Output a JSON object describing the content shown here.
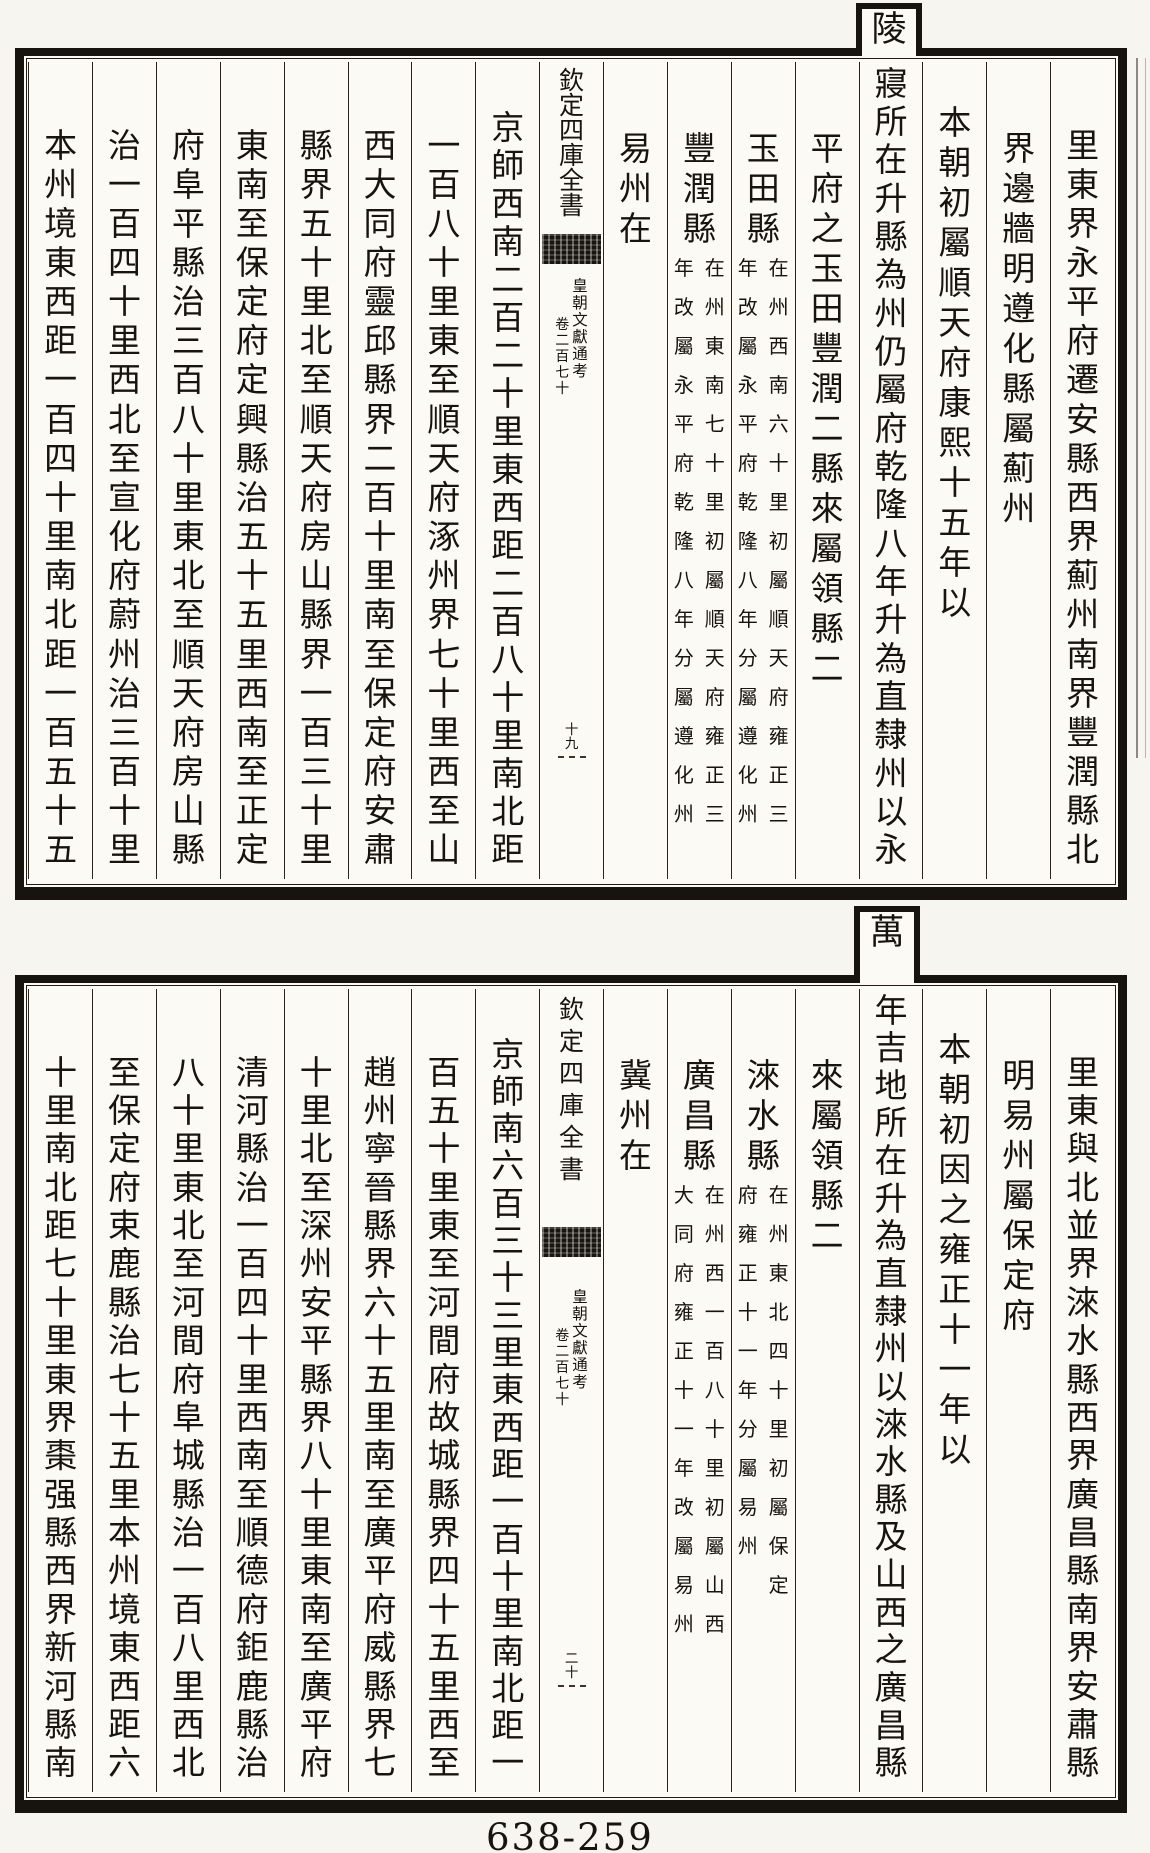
{
  "page": {
    "label": "638-259"
  },
  "blocks": [
    {
      "id": "top",
      "tab_char": "陵",
      "columns": [
        {
          "name": "top-col-r1",
          "text": "里東界永平府遷安縣西界薊州南界豐潤縣北",
          "fill": true
        },
        {
          "name": "top-col-r2",
          "text": "界邊牆明遵化縣屬薊州"
        },
        {
          "name": "top-col-r3",
          "text": "本朝初屬順天府康熙十五年以",
          "offset": 40
        },
        {
          "name": "top-col-r4-tab-lingqin",
          "text": "寢所在升縣為州仍屬府乾隆八年升為直隸州以永",
          "fill": true,
          "offset": 4
        },
        {
          "name": "top-col-r5",
          "text": "平府之玉田豐潤二縣來屬領縣二"
        },
        {
          "name": "top-col-r6",
          "text": "玉田縣",
          "note": {
            "right": "在州西南六十里初屬順天府雍正三",
            "left": "年改屬永平府乾隆八年分屬遵化州"
          }
        },
        {
          "name": "top-col-r7",
          "text": "豐潤縣",
          "note": {
            "right": "在州東南七十里初屬順天府雍正三",
            "left": "年改屬永平府乾隆八年分屬遵化州"
          }
        },
        {
          "name": "top-col-r8",
          "text": "易州在"
        },
        {
          "kind": "center",
          "name": "top-center-column",
          "title": "欽定四庫全書",
          "book": "皇朝文獻通考",
          "chapter": "卷二百七十",
          "folio": "十九",
          "titlePitch": 25,
          "titleTop": 6,
          "bandTop": 172,
          "bookTop": 216,
          "folioTop": 662
        },
        {
          "name": "top-col-l1",
          "text": "京師西南二百二十里東西距二百八十里南北距",
          "fill": true,
          "offset": 48
        },
        {
          "name": "top-col-l2",
          "text": "一百八十里東至順天府涿州界七十里西至山",
          "fill": true
        },
        {
          "name": "top-col-l3",
          "text": "西大同府靈邱縣界二百十里南至保定府安肅",
          "fill": true
        },
        {
          "name": "top-col-l4",
          "text": "縣界五十里北至順天府房山縣界一百三十里",
          "fill": true
        },
        {
          "name": "top-col-l5",
          "text": "東南至保定府定興縣治五十五里西南至正定",
          "fill": true
        },
        {
          "name": "top-col-l6",
          "text": "府阜平縣治三百八十里東北至順天府房山縣",
          "fill": true
        },
        {
          "name": "top-col-l7",
          "text": "治一百四十里西北至宣化府蔚州治三百十里",
          "fill": true
        },
        {
          "name": "top-col-l8",
          "text": "本州境東西距一百四十里南北距一百五十五",
          "fill": true
        }
      ]
    },
    {
      "id": "bottom",
      "tab_char": "萬",
      "columns": [
        {
          "name": "bottom-col-r1",
          "text": "里東與北並界淶水縣西界廣昌縣南界安肅縣",
          "fill": true
        },
        {
          "name": "bottom-col-r2",
          "text": "明易州屬保定府"
        },
        {
          "name": "bottom-col-r3",
          "text": "本朝初因之雍正十一年以",
          "offset": 40
        },
        {
          "name": "bottom-col-r4-tab-wannianjidi",
          "text": "年吉地所在升為直隸州以淶水縣及山西之廣昌縣",
          "fill": true,
          "offset": 4
        },
        {
          "name": "bottom-col-r5",
          "text": "來屬領縣二"
        },
        {
          "name": "bottom-col-r6",
          "text": "淶水縣",
          "note": {
            "right": "在州東北四十里初屬保定",
            "left": "府雍正十一年分屬易州"
          }
        },
        {
          "name": "bottom-col-r7",
          "text": "廣昌縣",
          "note": {
            "right": "在州西一百八十里初屬山西",
            "left": "大同府雍正十一年改屬易州"
          }
        },
        {
          "name": "bottom-col-r8",
          "text": "冀州在"
        },
        {
          "kind": "center",
          "name": "bottom-center-column",
          "title": "欽定四庫全書",
          "book": "皇朝文獻通考",
          "chapter": "卷二百七十",
          "folio": "二十",
          "titlePitch": 32,
          "titleTop": 4,
          "bandTop": 238,
          "bookTop": 300,
          "folioTop": 664
        },
        {
          "name": "bottom-col-l1",
          "text": "京師南六百三十三里東西距一百十里南北距一",
          "fill": true,
          "offset": 48
        },
        {
          "name": "bottom-col-l2",
          "text": "百五十里東至河間府故城縣界四十五里西至",
          "fill": true
        },
        {
          "name": "bottom-col-l3",
          "text": "趙州寧晉縣界六十五里南至廣平府威縣界七",
          "fill": true
        },
        {
          "name": "bottom-col-l4",
          "text": "十里北至深州安平縣界八十里東南至廣平府",
          "fill": true
        },
        {
          "name": "bottom-col-l5",
          "text": "清河縣治一百四十里西南至順德府鉅鹿縣治",
          "fill": true
        },
        {
          "name": "bottom-col-l6",
          "text": "八十里東北至河間府阜城縣治一百八里西北",
          "fill": true
        },
        {
          "name": "bottom-col-l7",
          "text": "至保定府束鹿縣治七十五里本州境東西距六",
          "fill": true
        },
        {
          "name": "bottom-col-l8",
          "text": "十里南北距七十里東界棗强縣西界新河縣南",
          "fill": true
        }
      ]
    }
  ]
}
